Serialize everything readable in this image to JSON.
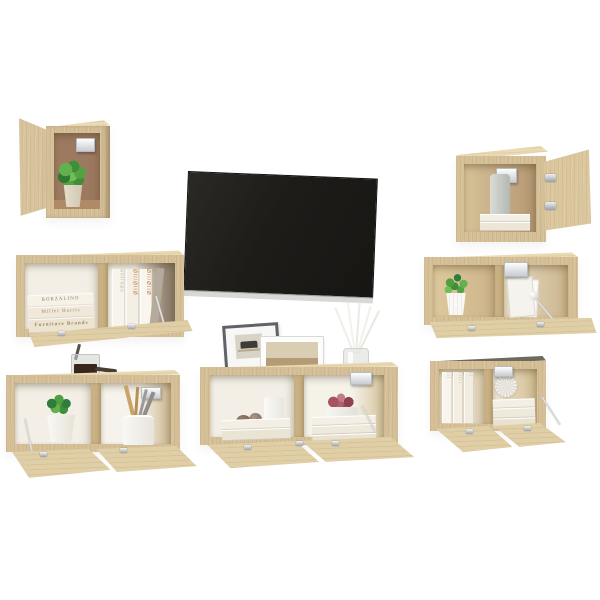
{
  "scene": {
    "background": "#ffffff"
  },
  "colors": {
    "bg": "#ffffff",
    "wood_front": "#d5bf97",
    "wood_top": "#e9dab3",
    "wood_side": "#b89c70",
    "wood_door": "#e0cfa6",
    "wood_divider": "#c9b184",
    "wood_dark_top": "#6f6a5d",
    "back_brown": "#9c7a60",
    "interior_white": "#f3efe6",
    "interior_dark": "#8d7f6e",
    "tv_screen": "#201f1c",
    "tv_bezel": "#d8d9d6",
    "metal": "#b7bbbf",
    "wire": "#dcdcda",
    "plant_green": "#55a244",
    "plant_dark": "#2e7d3c",
    "succulent_pink": "#b06070",
    "succulent_dark": "#8e4251",
    "pot_white": "#f9f8f4",
    "pot_beige": "#ddd5c0",
    "book_cream": "#f4efe4",
    "book_text": "#94835f",
    "spine_orange": "#c4763c",
    "glass": "#e4e7e2",
    "liquid_dark": "#38261b",
    "frame_gray": "#606268",
    "frame_white": "#fcfcfb",
    "photo_tan": "#c3a88a"
  },
  "books": {
    "stacked_titles": [
      "BORZALINO",
      "Miller Harris",
      "Furniture Brands"
    ],
    "vertical_spine_text": "antropo",
    "vertical_spine_marks": "ØII/ØIIØ"
  }
}
